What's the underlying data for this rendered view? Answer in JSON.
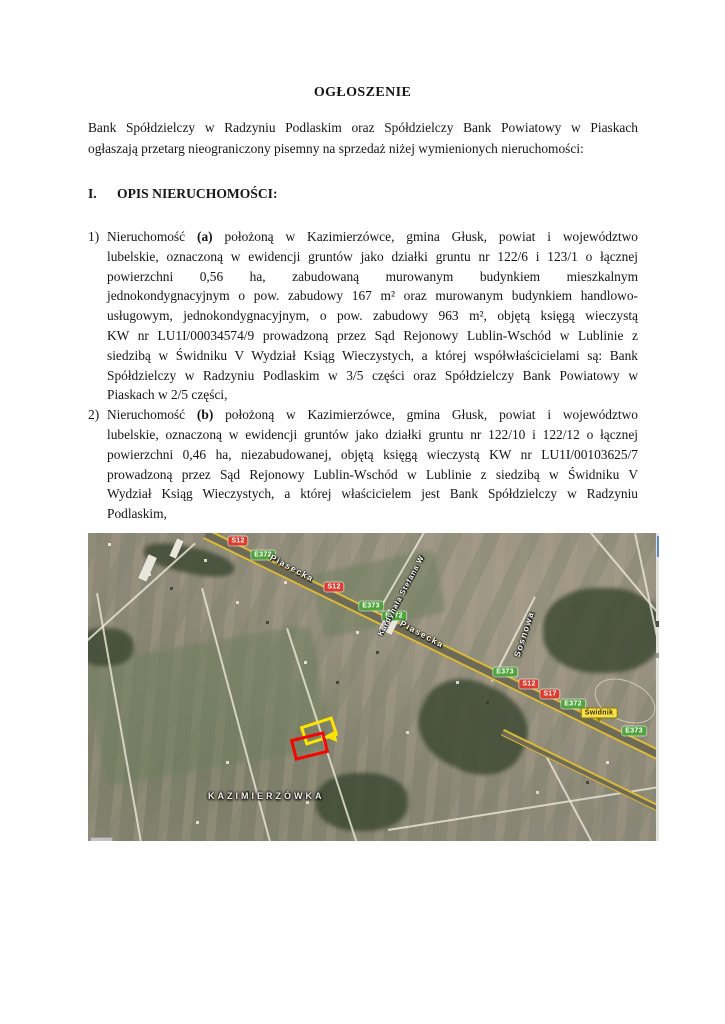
{
  "document": {
    "title": "OGŁOSZENIE",
    "intro": {
      "lines": [
        "Bank Spółdzielczy w Radzyniu Podlaskim oraz Spółdzielczy Bank Powiatowy w Piaskach",
        "ogłaszają przetarg nieograniczony pisemny na sprzedaż niżej wymienionych nieruchomości:"
      ]
    },
    "section": {
      "numeral": "I.",
      "title": "OPIS NIERUCHOMOŚCI:"
    },
    "items": [
      {
        "marker": "1)",
        "lines": [
          "Nieruchomość (a) położoną w Kazimierzówce, gmina Głusk, powiat i województwo",
          "lubelskie, oznaczoną w ewidencji gruntów jako działki gruntu nr 122/6 i 123/1 o łącznej",
          "powierzchni 0,56 ha, zabudowaną murowanym budynkiem mieszkalnym",
          "jednokondygnacyjnym o pow. zabudowy 167 m² oraz murowanym budynkiem handlowo-",
          "usługowym, jednokondygnacyjnym, o pow. zabudowy 963 m², objętą księgą wieczystą",
          "KW nr LU1I/00034574/9 prowadzoną przez Sąd Rejonowy Lublin-Wschód w Lublinie z",
          "siedzibą w Świdniku V Wydział Ksiąg Wieczystych, a której współwłaścicielami są: Bank",
          "Spółdzielczy w Radzyniu Podlaskim w 3/5 części oraz Spółdzielczy Bank Powiatowy w",
          "Piaskach w 2/5 części,"
        ]
      },
      {
        "marker": "2)",
        "lines": [
          "Nieruchomość (b) położoną w Kazimierzówce, gmina Głusk, powiat i województwo",
          "lubelskie, oznaczoną w ewidencji gruntów jako działki gruntu nr 122/10 i 122/12 o łącznej",
          "powierzchni 0,46 ha, niezabudowanej, objętą księgą wieczystą KW nr LU1I/00103625/7",
          "prowadzoną przez Sąd Rejonowy Lublin-Wschód w Lublinie z siedzibą w Świdniku V",
          "Wydział Ksiąg Wieczystych, a której właścicielem jest Bank Spółdzielczy w Radzyniu",
          "Podlaskim,"
        ]
      }
    ],
    "bold_tokens": [
      "(a)",
      "(b)"
    ]
  },
  "map": {
    "route_badges": [
      {
        "label": "S12",
        "type": "national"
      },
      {
        "label": "E372",
        "type": "european"
      },
      {
        "label": "S12",
        "type": "national"
      },
      {
        "label": "E373",
        "type": "european"
      },
      {
        "label": "E372",
        "type": "european"
      },
      {
        "label": "E373",
        "type": "european"
      },
      {
        "label": "S12",
        "type": "national"
      },
      {
        "label": "S17",
        "type": "national"
      },
      {
        "label": "E372",
        "type": "european"
      },
      {
        "label": "E373",
        "type": "european"
      }
    ],
    "town_badge": {
      "label": "Świdnik"
    },
    "street_labels": [
      "Piasecka",
      "Piasecka",
      "Kardynała Stefana W",
      "Sosnowa"
    ],
    "place_label": "KAZIMIERZÓWKA",
    "colors": {
      "route_national_badge": "#dd3c2e",
      "route_european_badge": "#4fa53c",
      "town_badge": "#f7e04b",
      "main_road_stripe": "#dcbb38",
      "field_tan": "#8e8878",
      "field_green": "#707e5c",
      "forest": "#3a4630",
      "parcel_a_outline": "#ffe400",
      "parcel_b_outline": "#f50400"
    }
  }
}
